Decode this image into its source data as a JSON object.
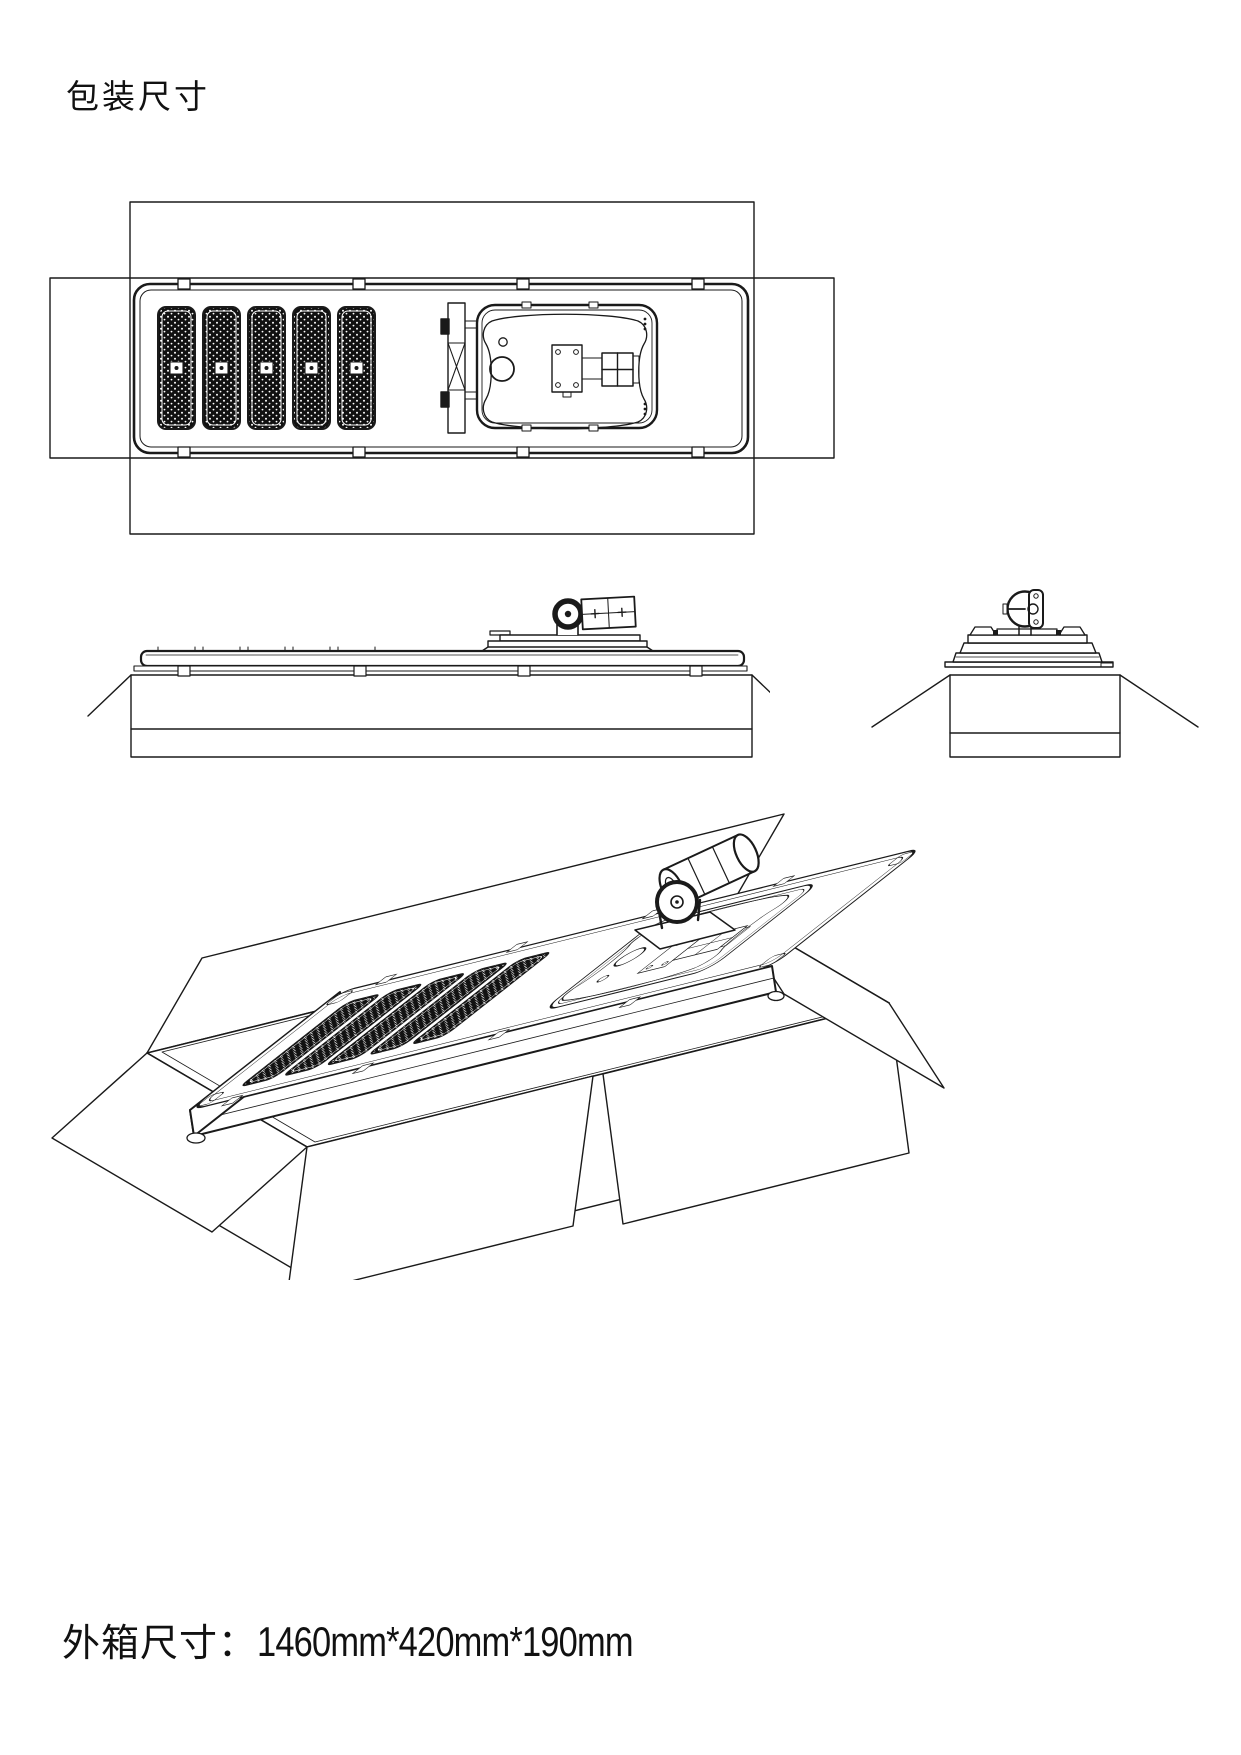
{
  "page": {
    "title": "包装尺寸"
  },
  "footer": {
    "label": "外箱尺寸：",
    "value": "1460mm*420mm*190mm"
  },
  "drawing": {
    "views": {
      "top_view": "packed street light, plan view in open carton",
      "side_view": "packed street light, long side elevation",
      "end_view": "packed street light, end elevation",
      "isometric_view": "packed street light, isometric in open carton"
    },
    "outer_box_dimensions_mm": {
      "length": 1460,
      "width": 420,
      "height": 190
    },
    "solar_panel_count": 5
  },
  "colors": {
    "line": "#1a1a1a",
    "panel_fill": "#111111",
    "background": "#ffffff"
  }
}
